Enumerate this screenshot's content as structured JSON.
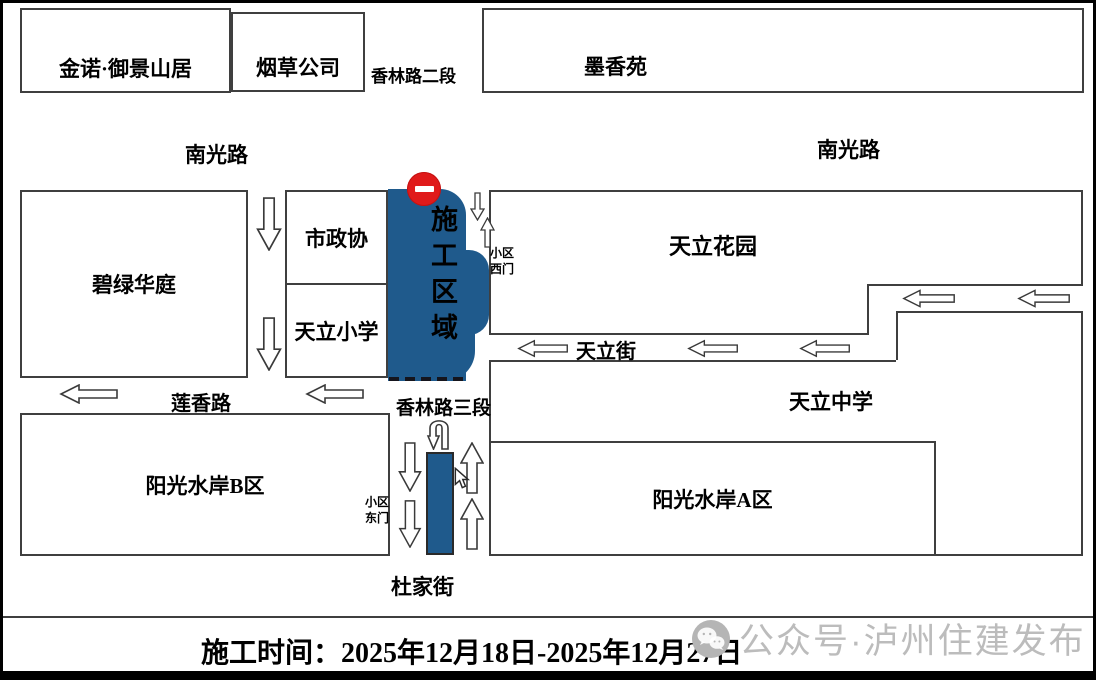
{
  "buildings": {
    "jinnuo": "金诺·御景山居",
    "yancao": "烟草公司",
    "moxiangyuan": "墨香苑",
    "bilvhuating": "碧绿华庭",
    "shizhengxie": "市政协",
    "tianli_xiaoxue": "天立小学",
    "tianli_huayuan": "天立花园",
    "tianli_zhongxue": "天立中学",
    "yangguang_a": "阳光水岸A区",
    "yangguang_b": "阳光水岸B区"
  },
  "roads": {
    "xianglin_2": "香林路二段",
    "xianglin_3": "香林路三段",
    "nanguang_left": "南光路",
    "nanguang_right": "南光路",
    "lianxiang": "莲香路",
    "tianli_street": "天立街",
    "dujia": "杜家街"
  },
  "gates": {
    "west_line1": "小区",
    "west_line2": "西门",
    "east_line1": "小区",
    "east_line2": "东门"
  },
  "construction_zone": {
    "label": "施工区域",
    "zone_color": "#1F5A8C",
    "no_entry_color": "#E01A1A"
  },
  "caption": {
    "text": "施工时间：2025年12月18日-2025年12月27日"
  },
  "watermark": {
    "text": "公众号·泸州住建发布",
    "color": "#bcbcbc"
  }
}
